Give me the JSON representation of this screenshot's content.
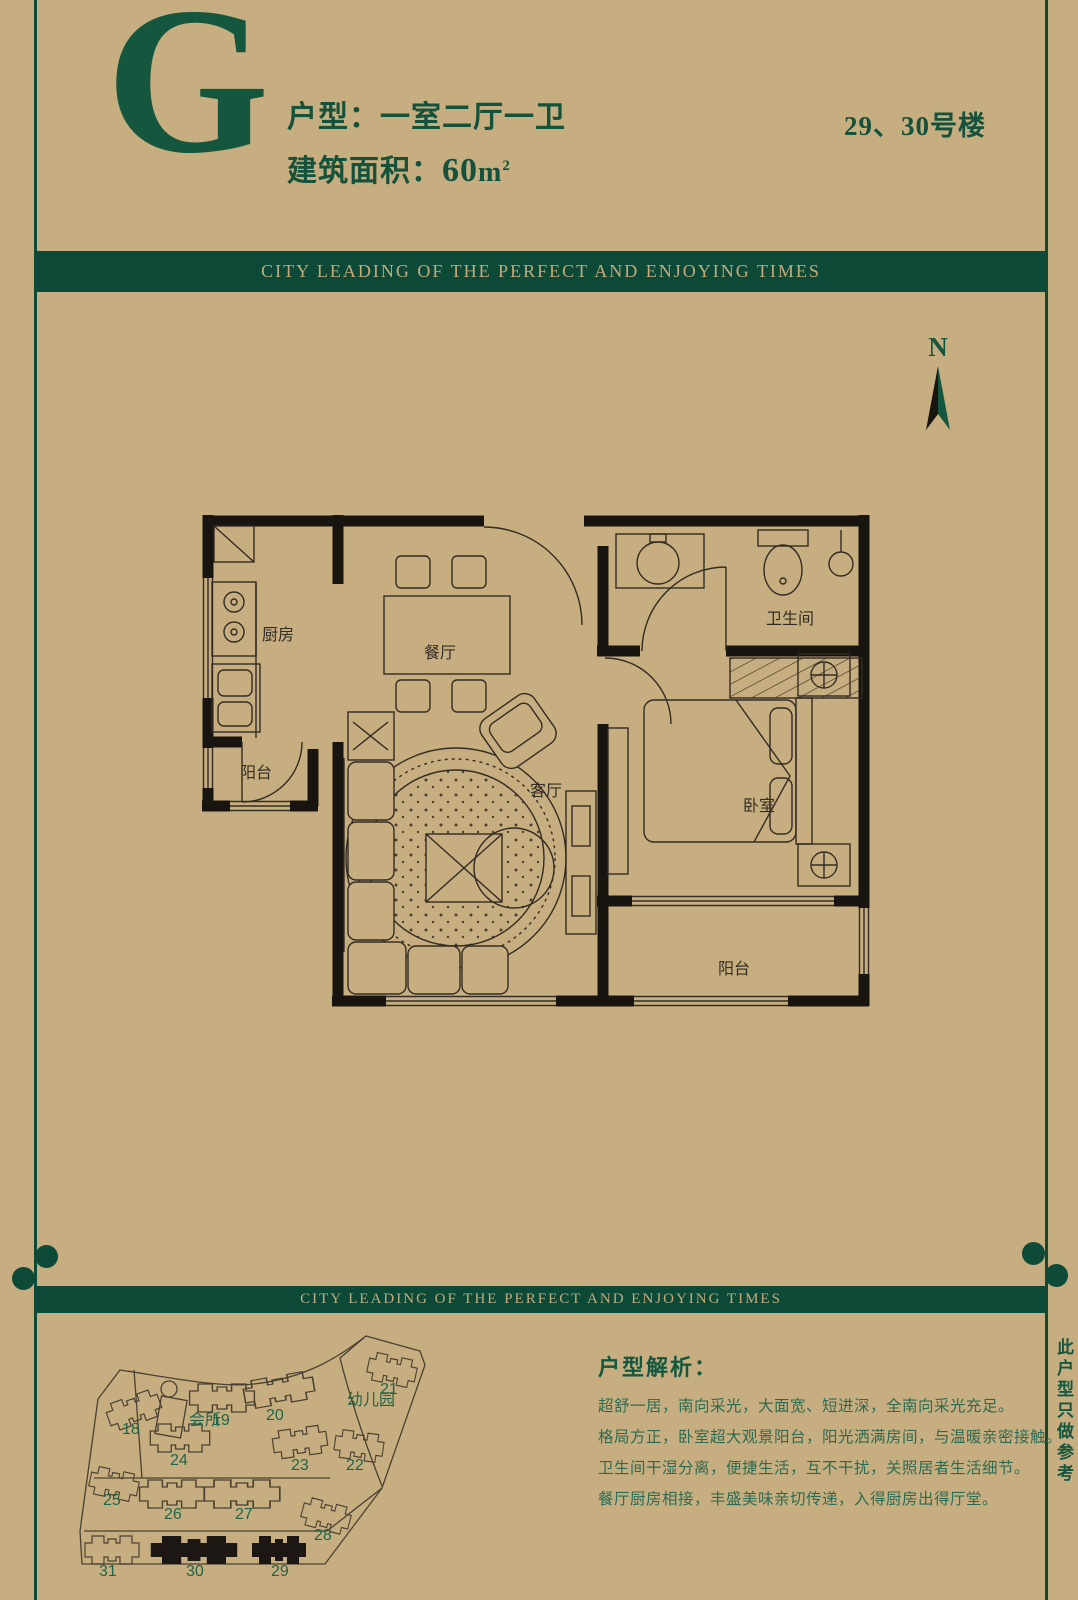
{
  "page": {
    "background": "#c7ae81",
    "green_bar": "#0c4a37",
    "green_text": "#14523b"
  },
  "header": {
    "letter": "G",
    "unit_label": "户型：一室二厅一卫",
    "area_label": "建筑面积：",
    "area_value": "60",
    "area_unit": "m",
    "area_sup": "2",
    "building_no": "29、30号楼"
  },
  "banner": {
    "text": "CITY LEADING OF THE PERFECT AND ENJOYING TIMES"
  },
  "compass": {
    "label": "N"
  },
  "floorplan": {
    "rooms": [
      {
        "key": "kitchen",
        "name": "厨房",
        "x": 64,
        "y": 134
      },
      {
        "key": "dining",
        "name": "餐厅",
        "x": 226,
        "y": 152
      },
      {
        "key": "bathroom",
        "name": "卫生间",
        "x": 568,
        "y": 118
      },
      {
        "key": "bedroom",
        "name": "卧室",
        "x": 545,
        "y": 305
      },
      {
        "key": "balcony-south",
        "name": "阳台",
        "x": 520,
        "y": 468
      },
      {
        "key": "balcony-west",
        "name": "阳台",
        "x": 42,
        "y": 272
      },
      {
        "key": "living",
        "name": "客厅",
        "x": 332,
        "y": 290
      }
    ]
  },
  "sitemap": {
    "areas": [
      {
        "label": "会所",
        "x": 117,
        "y": 99
      },
      {
        "label": "幼儿园",
        "x": 275,
        "y": 79
      }
    ],
    "buildings": [
      {
        "label": "18",
        "x": 50,
        "y": 108,
        "bx": 62,
        "by": 84,
        "rot": -20,
        "filled": false,
        "w": 1
      },
      {
        "label": "19",
        "x": 140,
        "y": 99,
        "bx": 150,
        "by": 72,
        "rot": 0,
        "filled": false,
        "w": 1.2
      },
      {
        "label": "20",
        "x": 194,
        "y": 94,
        "bx": 207,
        "by": 64,
        "rot": -10,
        "filled": false,
        "w": 1.3
      },
      {
        "label": "21",
        "x": 308,
        "y": 68,
        "bx": 320,
        "by": 44,
        "rot": 12,
        "filled": false,
        "w": 0.9
      },
      {
        "label": "22",
        "x": 274,
        "y": 144,
        "bx": 287,
        "by": 120,
        "rot": 8,
        "filled": false,
        "w": 0.9
      },
      {
        "label": "23",
        "x": 219,
        "y": 144,
        "bx": 228,
        "by": 116,
        "rot": -8,
        "filled": false,
        "w": 1
      },
      {
        "label": "24",
        "x": 98,
        "y": 139,
        "bx": 108,
        "by": 112,
        "rot": 0,
        "filled": false,
        "w": 1.1
      },
      {
        "label": "25",
        "x": 31,
        "y": 179,
        "bx": 42,
        "by": 158,
        "rot": 12,
        "filled": false,
        "w": 0.9
      },
      {
        "label": "26",
        "x": 92,
        "y": 193,
        "bx": 100,
        "by": 168,
        "rot": 0,
        "filled": false,
        "w": 1.2
      },
      {
        "label": "27",
        "x": 163,
        "y": 193,
        "bx": 170,
        "by": 168,
        "rot": 0,
        "filled": false,
        "w": 1.4
      },
      {
        "label": "28",
        "x": 242,
        "y": 214,
        "bx": 254,
        "by": 190,
        "rot": 15,
        "filled": false,
        "w": 0.9
      },
      {
        "label": "31",
        "x": 27,
        "y": 250,
        "bx": 40,
        "by": 224,
        "rot": 0,
        "filled": false,
        "w": 1
      },
      {
        "label": "30",
        "x": 114,
        "y": 250,
        "bx": 122,
        "by": 224,
        "rot": 0,
        "filled": true,
        "w": 1.6
      },
      {
        "label": "29",
        "x": 199,
        "y": 250,
        "bx": 207,
        "by": 224,
        "rot": 0,
        "filled": true,
        "w": 1
      }
    ]
  },
  "analysis": {
    "title": "户型解析：",
    "lines": [
      "超舒一居，南向采光，大面宽、短进深，全南向采光充足。",
      "格局方正，卧室超大观景阳台，阳光洒满房间，与温暖亲密接触。",
      "卫生间干湿分离，便捷生活，互不干扰，关照居者生活细节。",
      "餐厅厨房相接，丰盛美味亲切传递，入得厨房出得厅堂。"
    ]
  },
  "side_note": "此户型只做参考"
}
